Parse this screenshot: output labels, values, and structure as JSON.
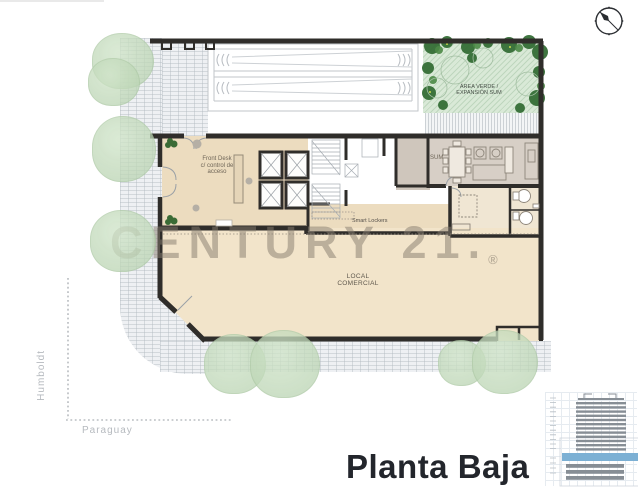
{
  "title": {
    "text": "Planta Baja"
  },
  "watermark": {
    "brand": "CENTURY 21.",
    "registered": "®"
  },
  "streets": {
    "vertical": "Humboldt",
    "horizontal": "Paraguay"
  },
  "labels": {
    "area_verde_1": "ÁREA VERDE /",
    "area_verde_2": "EXPANSIÓN SUM",
    "sum": "SUM",
    "front_desk_1": "Front Desk",
    "front_desk_2": "c/ control de",
    "front_desk_3": "acceso",
    "smart_lockers": "Smart Lockers",
    "local_1": "LOCAL",
    "local_2": "COMERCIAL"
  },
  "icons": {
    "compass": "compass-north-icon",
    "tower": "building-elevation-icon"
  },
  "colors": {
    "wall": "#2f2d2a",
    "local_floor": "#f2e4ca",
    "lobby_floor": "#ecdcbf",
    "sum_floor": "#d7cfc6",
    "vestibule_floor": "#cfc6bc",
    "annex_floor": "#f0e6d3",
    "green_area": "#d9e9d7",
    "green_tree_dark": "#356e36",
    "tree_soft": "#cfe2c8",
    "sidewalk": "#eef0f3",
    "floor_highlight_blue": "#7cb0d4",
    "title_text": "#23262c",
    "watermark_text": "#867c6e"
  }
}
